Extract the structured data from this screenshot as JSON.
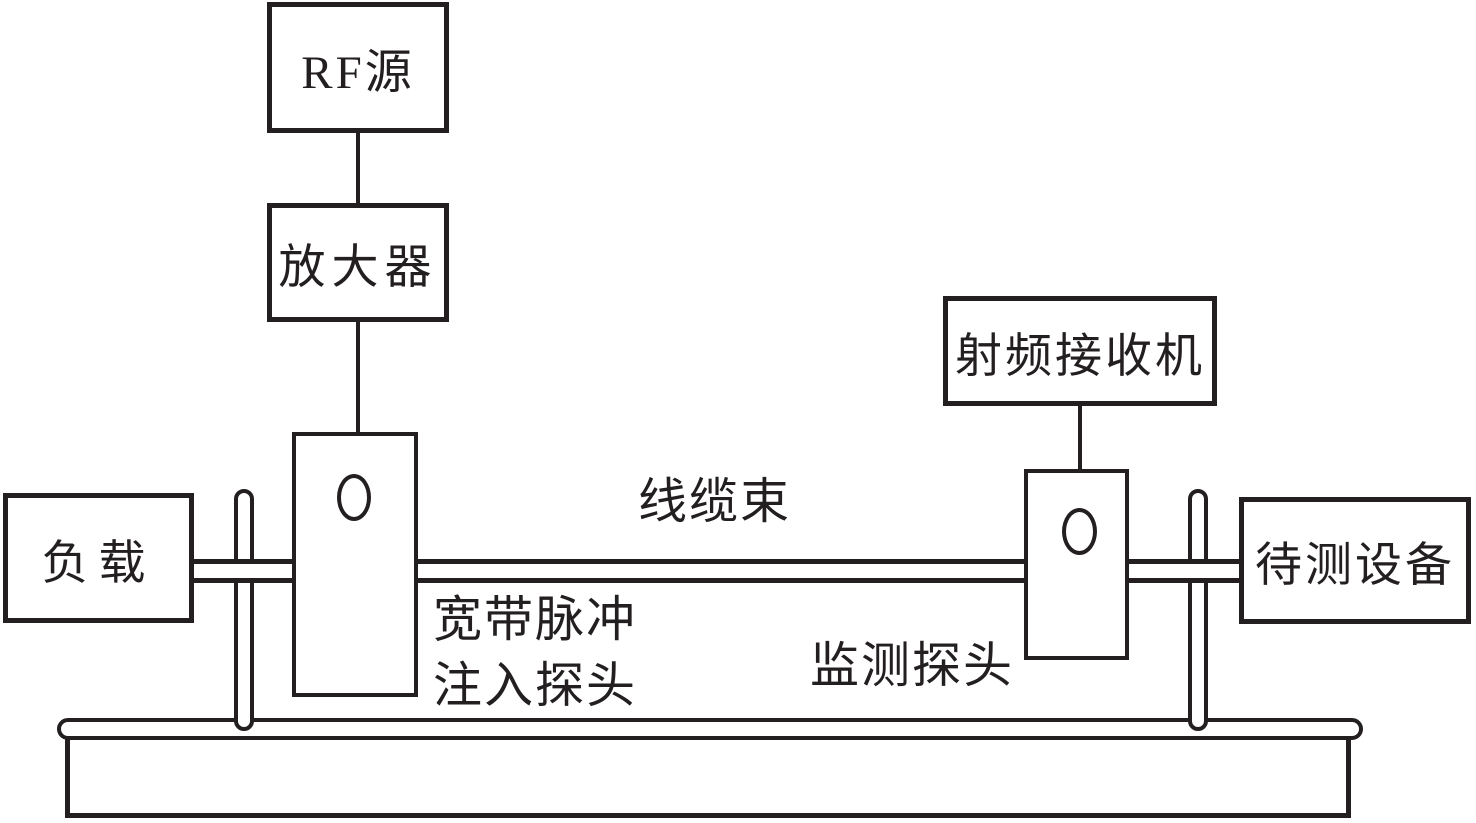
{
  "diagram": {
    "boxes": {
      "rf_source": {
        "label": "RF源"
      },
      "amplifier": {
        "label": "放大器"
      },
      "rf_receiver": {
        "label": "射频接收机"
      },
      "load": {
        "label": "负载"
      },
      "dut": {
        "label": "待测设备"
      }
    },
    "labels": {
      "cable_bundle": "线缆束",
      "injection_probe_line1": "宽带脉冲",
      "injection_probe_line2": "注入探头",
      "monitor_probe": "监测探头"
    },
    "colors": {
      "stroke": "#231f20",
      "background": "#ffffff"
    }
  }
}
